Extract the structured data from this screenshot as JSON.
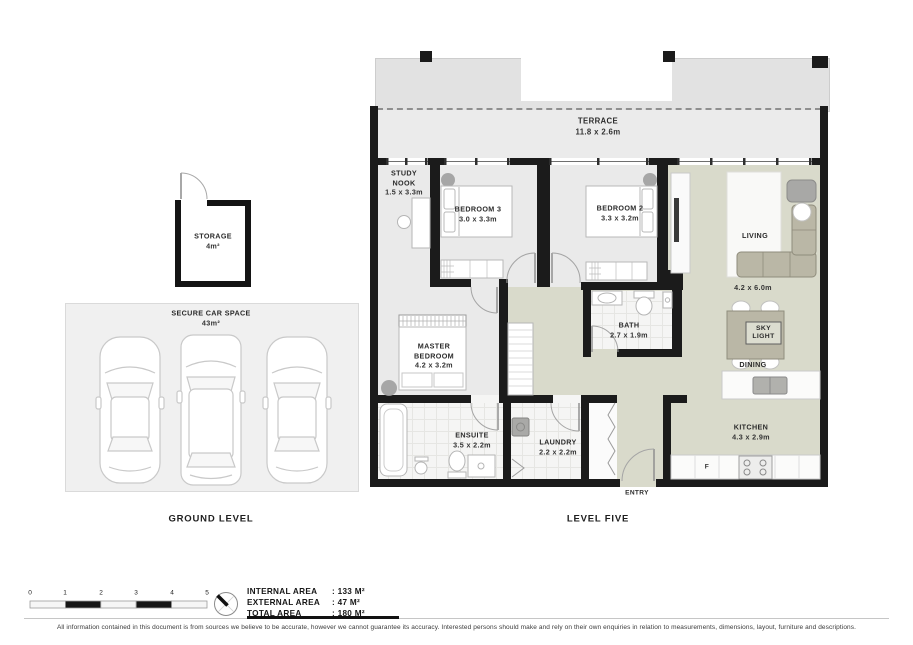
{
  "plan": {
    "level_five": {
      "title": "LEVEL FIVE",
      "terrace": {
        "name": "TERRACE",
        "dims": "11.8 x 2.6m"
      },
      "rooms": {
        "study_nook": {
          "line1": "STUDY",
          "line2": "NOOK",
          "dims": "1.5 x 3.3m"
        },
        "bedroom3": {
          "name": "BEDROOM 3",
          "dims": "3.0 x 3.3m"
        },
        "bedroom2": {
          "name": "BEDROOM 2",
          "dims": "3.3 x 3.2m"
        },
        "living": {
          "name": "LIVING",
          "dims": "4.2 x 6.0m"
        },
        "dining": {
          "name": "DINING"
        },
        "skylight": {
          "line1": "SKY",
          "line2": "LIGHT"
        },
        "master": {
          "line1": "MASTER",
          "line2": "BEDROOM",
          "dims": "4.2 x 3.2m"
        },
        "bath": {
          "name": "BATH",
          "dims": "2.7 x 1.9m"
        },
        "ensuite": {
          "name": "ENSUITE",
          "dims": "3.5 x 2.2m"
        },
        "laundry": {
          "name": "LAUNDRY",
          "dims": "2.2 x 2.2m"
        },
        "kitchen": {
          "name": "KITCHEN",
          "dims": "4.3 x 2.9m"
        },
        "entry": {
          "name": "ENTRY"
        },
        "fridge": {
          "label": "F"
        }
      }
    },
    "ground_level": {
      "title": "GROUND LEVEL",
      "storage": {
        "name": "STORAGE",
        "area": "4m²"
      },
      "car_space": {
        "name": "SECURE CAR SPACE",
        "area": "43m²"
      }
    }
  },
  "legend": {
    "scale_ticks": [
      "0",
      "1",
      "2",
      "3",
      "4",
      "5"
    ],
    "areas": [
      {
        "label": "INTERNAL AREA",
        "value": ": 133 M²"
      },
      {
        "label": "EXTERNAL AREA",
        "value": ": 47 M²"
      },
      {
        "label": "TOTAL AREA",
        "value": ": 180 M²"
      }
    ]
  },
  "footer": {
    "disclaimer": "All information contained in this document is from sources we believe to be accurate, however we cannot guarantee its accuracy. Interested persons should make and rely on their own enquiries in relation to measurements, dimensions, layout, furniture and descriptions."
  },
  "colors": {
    "wall": "#1b1b1b",
    "bedroom_floor": "#eaeaea",
    "living_floor": "#d9dacb",
    "tile_floor": "#f5f5f4",
    "terrace_floor": "#ebebeb",
    "roof_overhang": "#e2e2e2",
    "furniture_beige": "#bab7a6",
    "column_gray": "#9e9e9e"
  }
}
